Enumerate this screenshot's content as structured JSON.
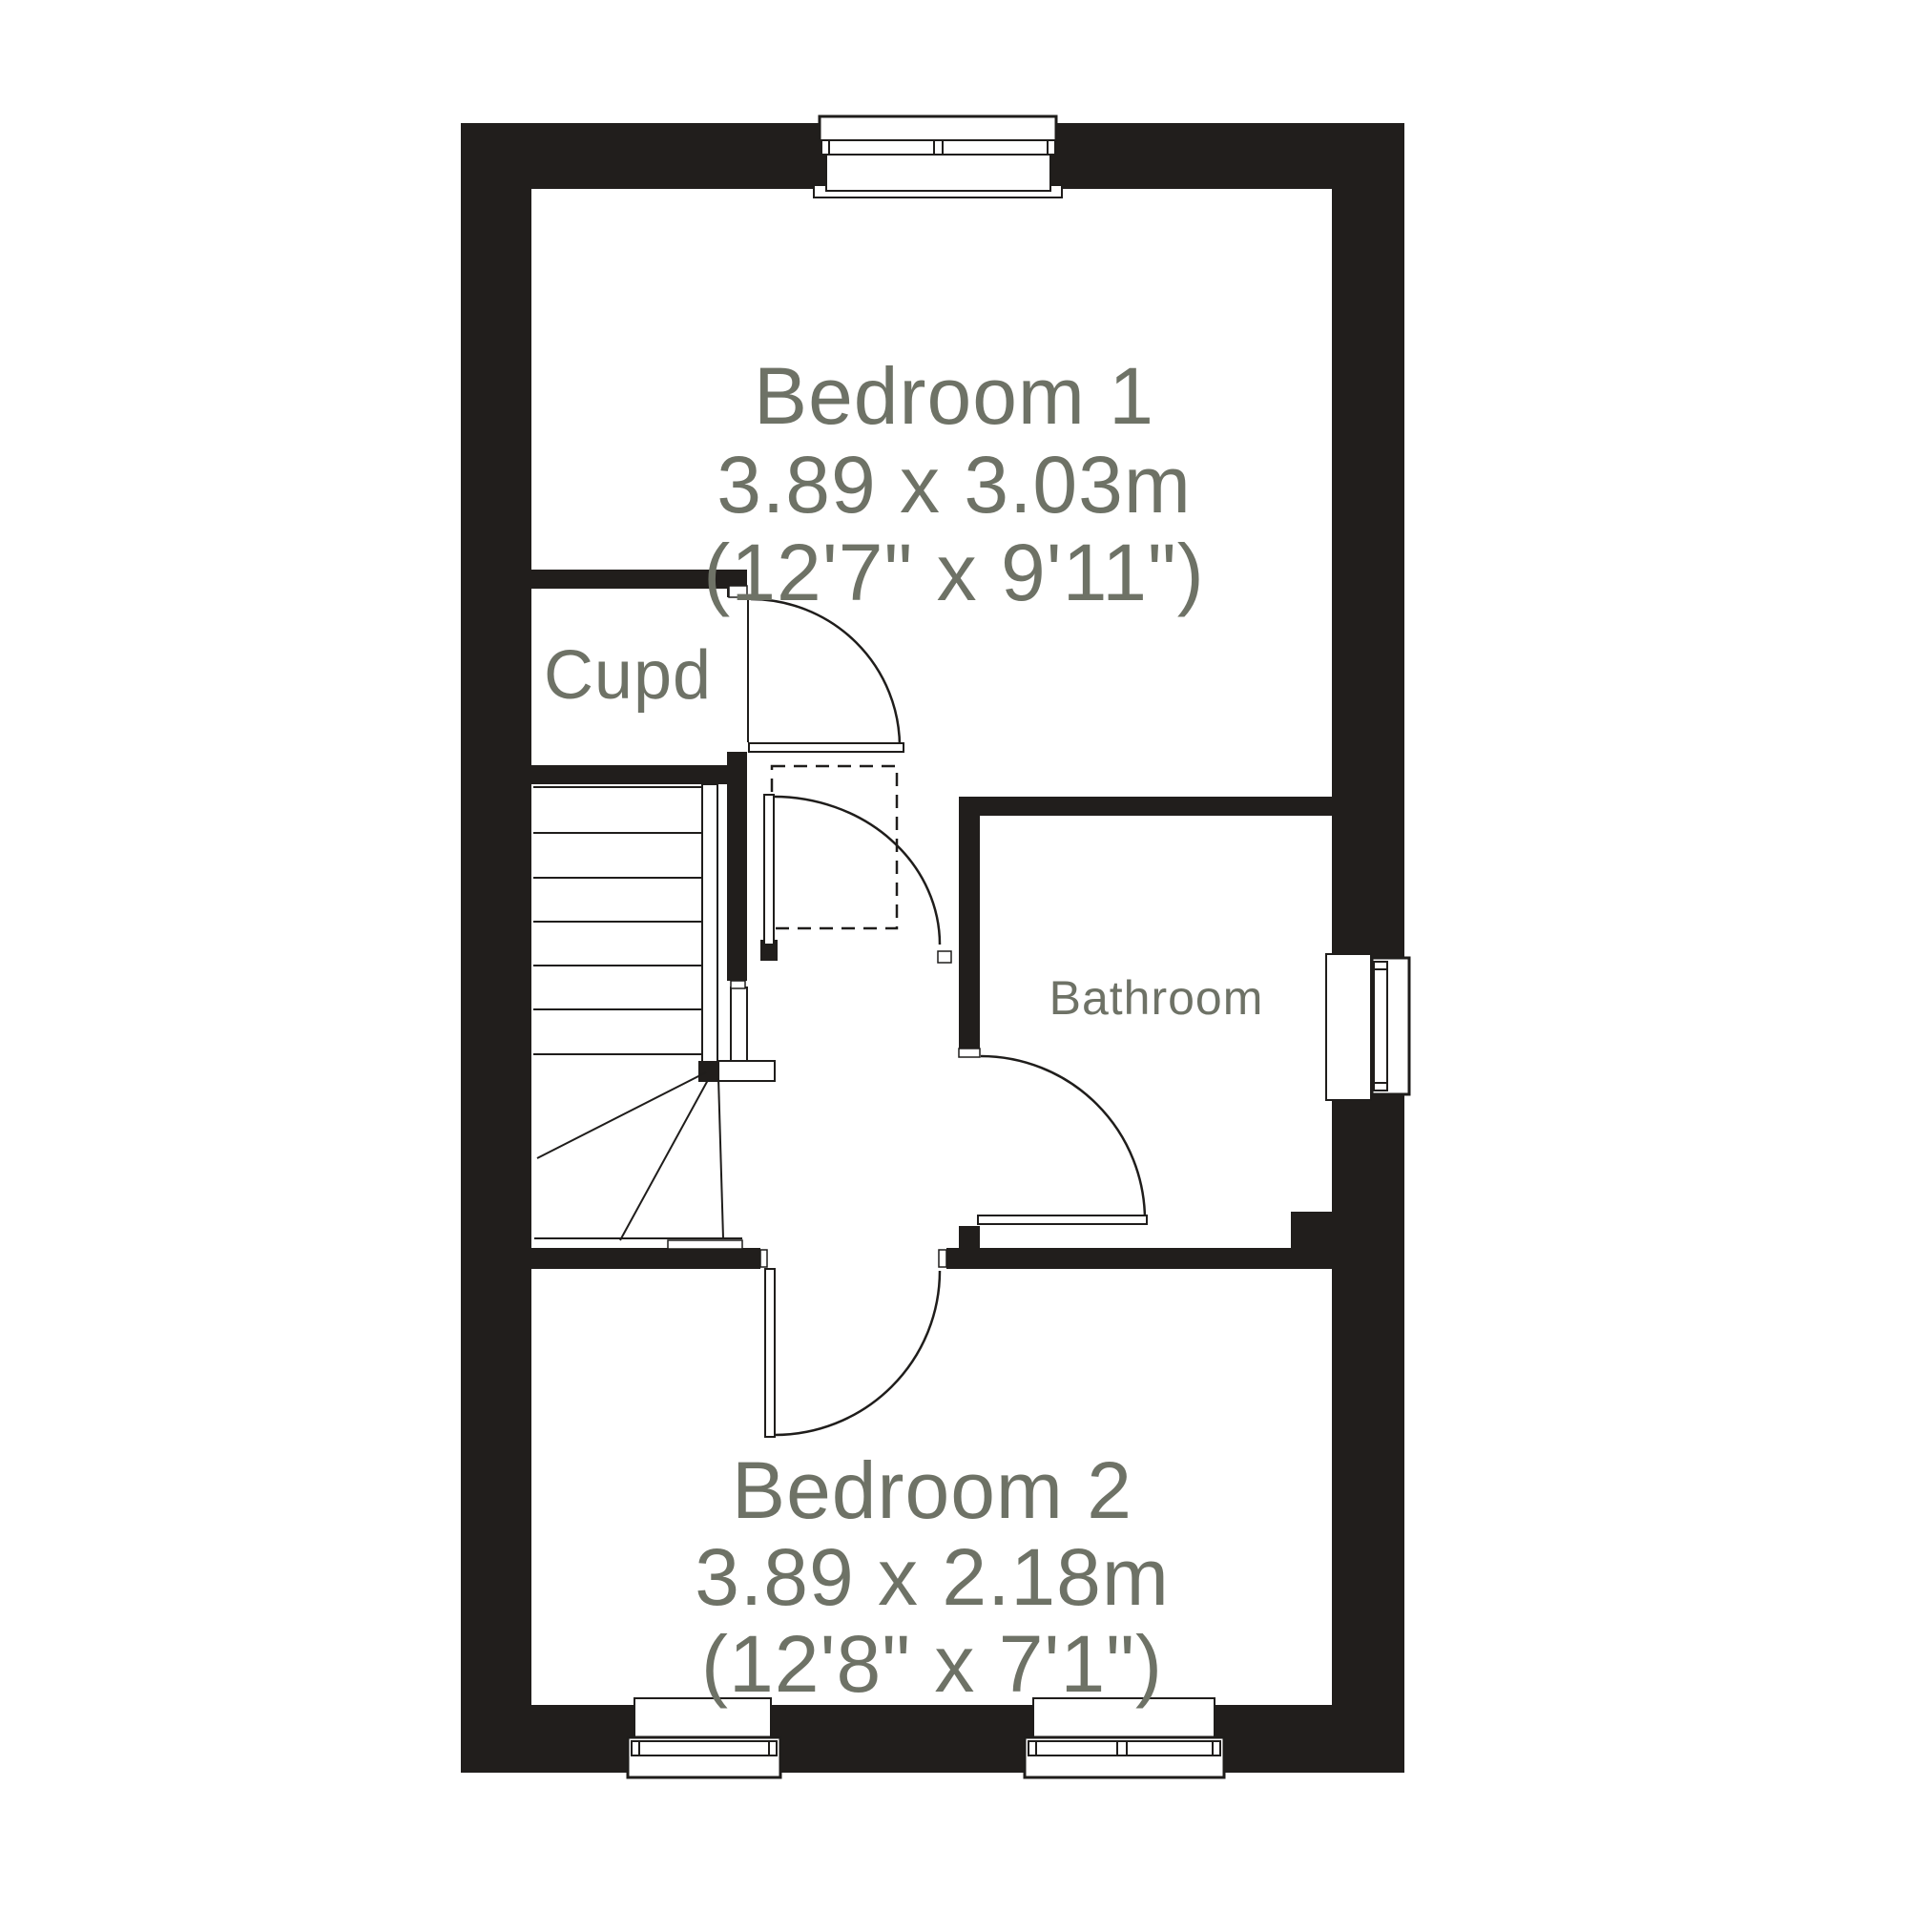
{
  "rooms": {
    "bedroom1": {
      "label": "Bedroom 1",
      "metric": "3.89 x 3.03m",
      "imperial": "(12'7\" x 9'11\")"
    },
    "cupboard": {
      "label": "Cupd"
    },
    "bathroom": {
      "label": "Bathroom"
    },
    "bedroom2": {
      "label": "Bedroom 2",
      "metric": "3.89 x 2.18m",
      "imperial": "(12'8\" x 7'1\")"
    }
  },
  "colors": {
    "wall": "#211e1c",
    "line": "#1f1d1b",
    "label": "#6e7266",
    "background": "#ffffff"
  }
}
